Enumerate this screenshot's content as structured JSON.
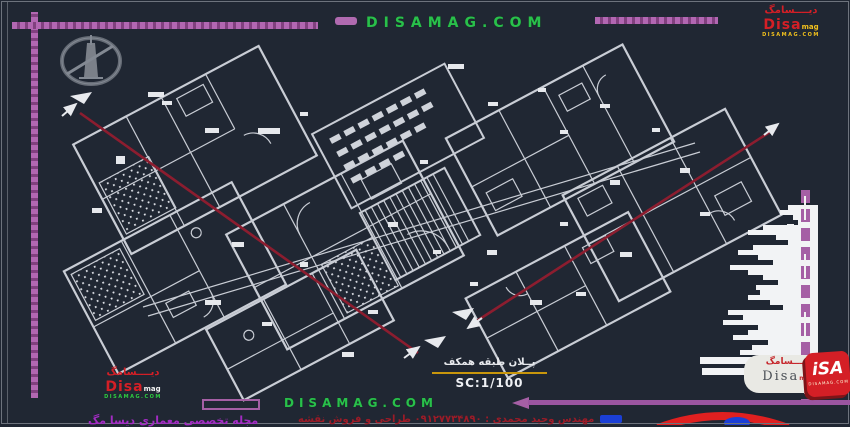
{
  "site": {
    "domain_top": "DISAMAG.COM",
    "domain_bottom": "DISAMAG.COM"
  },
  "logo": {
    "script_fa": "ديــــسامگ",
    "name": "Disa",
    "suffix": "mag",
    "url_small": "DISAMAG.COM"
  },
  "pill_logo": {
    "script_fa": "ديـــسامگ",
    "name": "Disa",
    "suffix": "mag"
  },
  "cube_logo": {
    "text": "iSA",
    "sub": "DISAMAG.COM"
  },
  "plan": {
    "title_fa": "پــلان طبقه همکف",
    "scale_label": "SC:1/100"
  },
  "footer": {
    "credit_fa": "مهندس وحید محمدی : ۰۹۱۲۷۷۳۴۸۹۰ طراحی و فروش نقشه",
    "magazine_fa": "مجله تخصصی معماری دیسا مگ"
  },
  "colors": {
    "background": "#202733",
    "plan_lines": "#c9cdd5",
    "border_purple": "#a55fa5",
    "site_green": "#29c04b",
    "logo_red": "#d41f26",
    "section_red": "#8c1d2f",
    "caption_rule_yellow": "#c8960c",
    "credit_red": "#9c1b27",
    "magazine_purple": "#a32bc4"
  }
}
